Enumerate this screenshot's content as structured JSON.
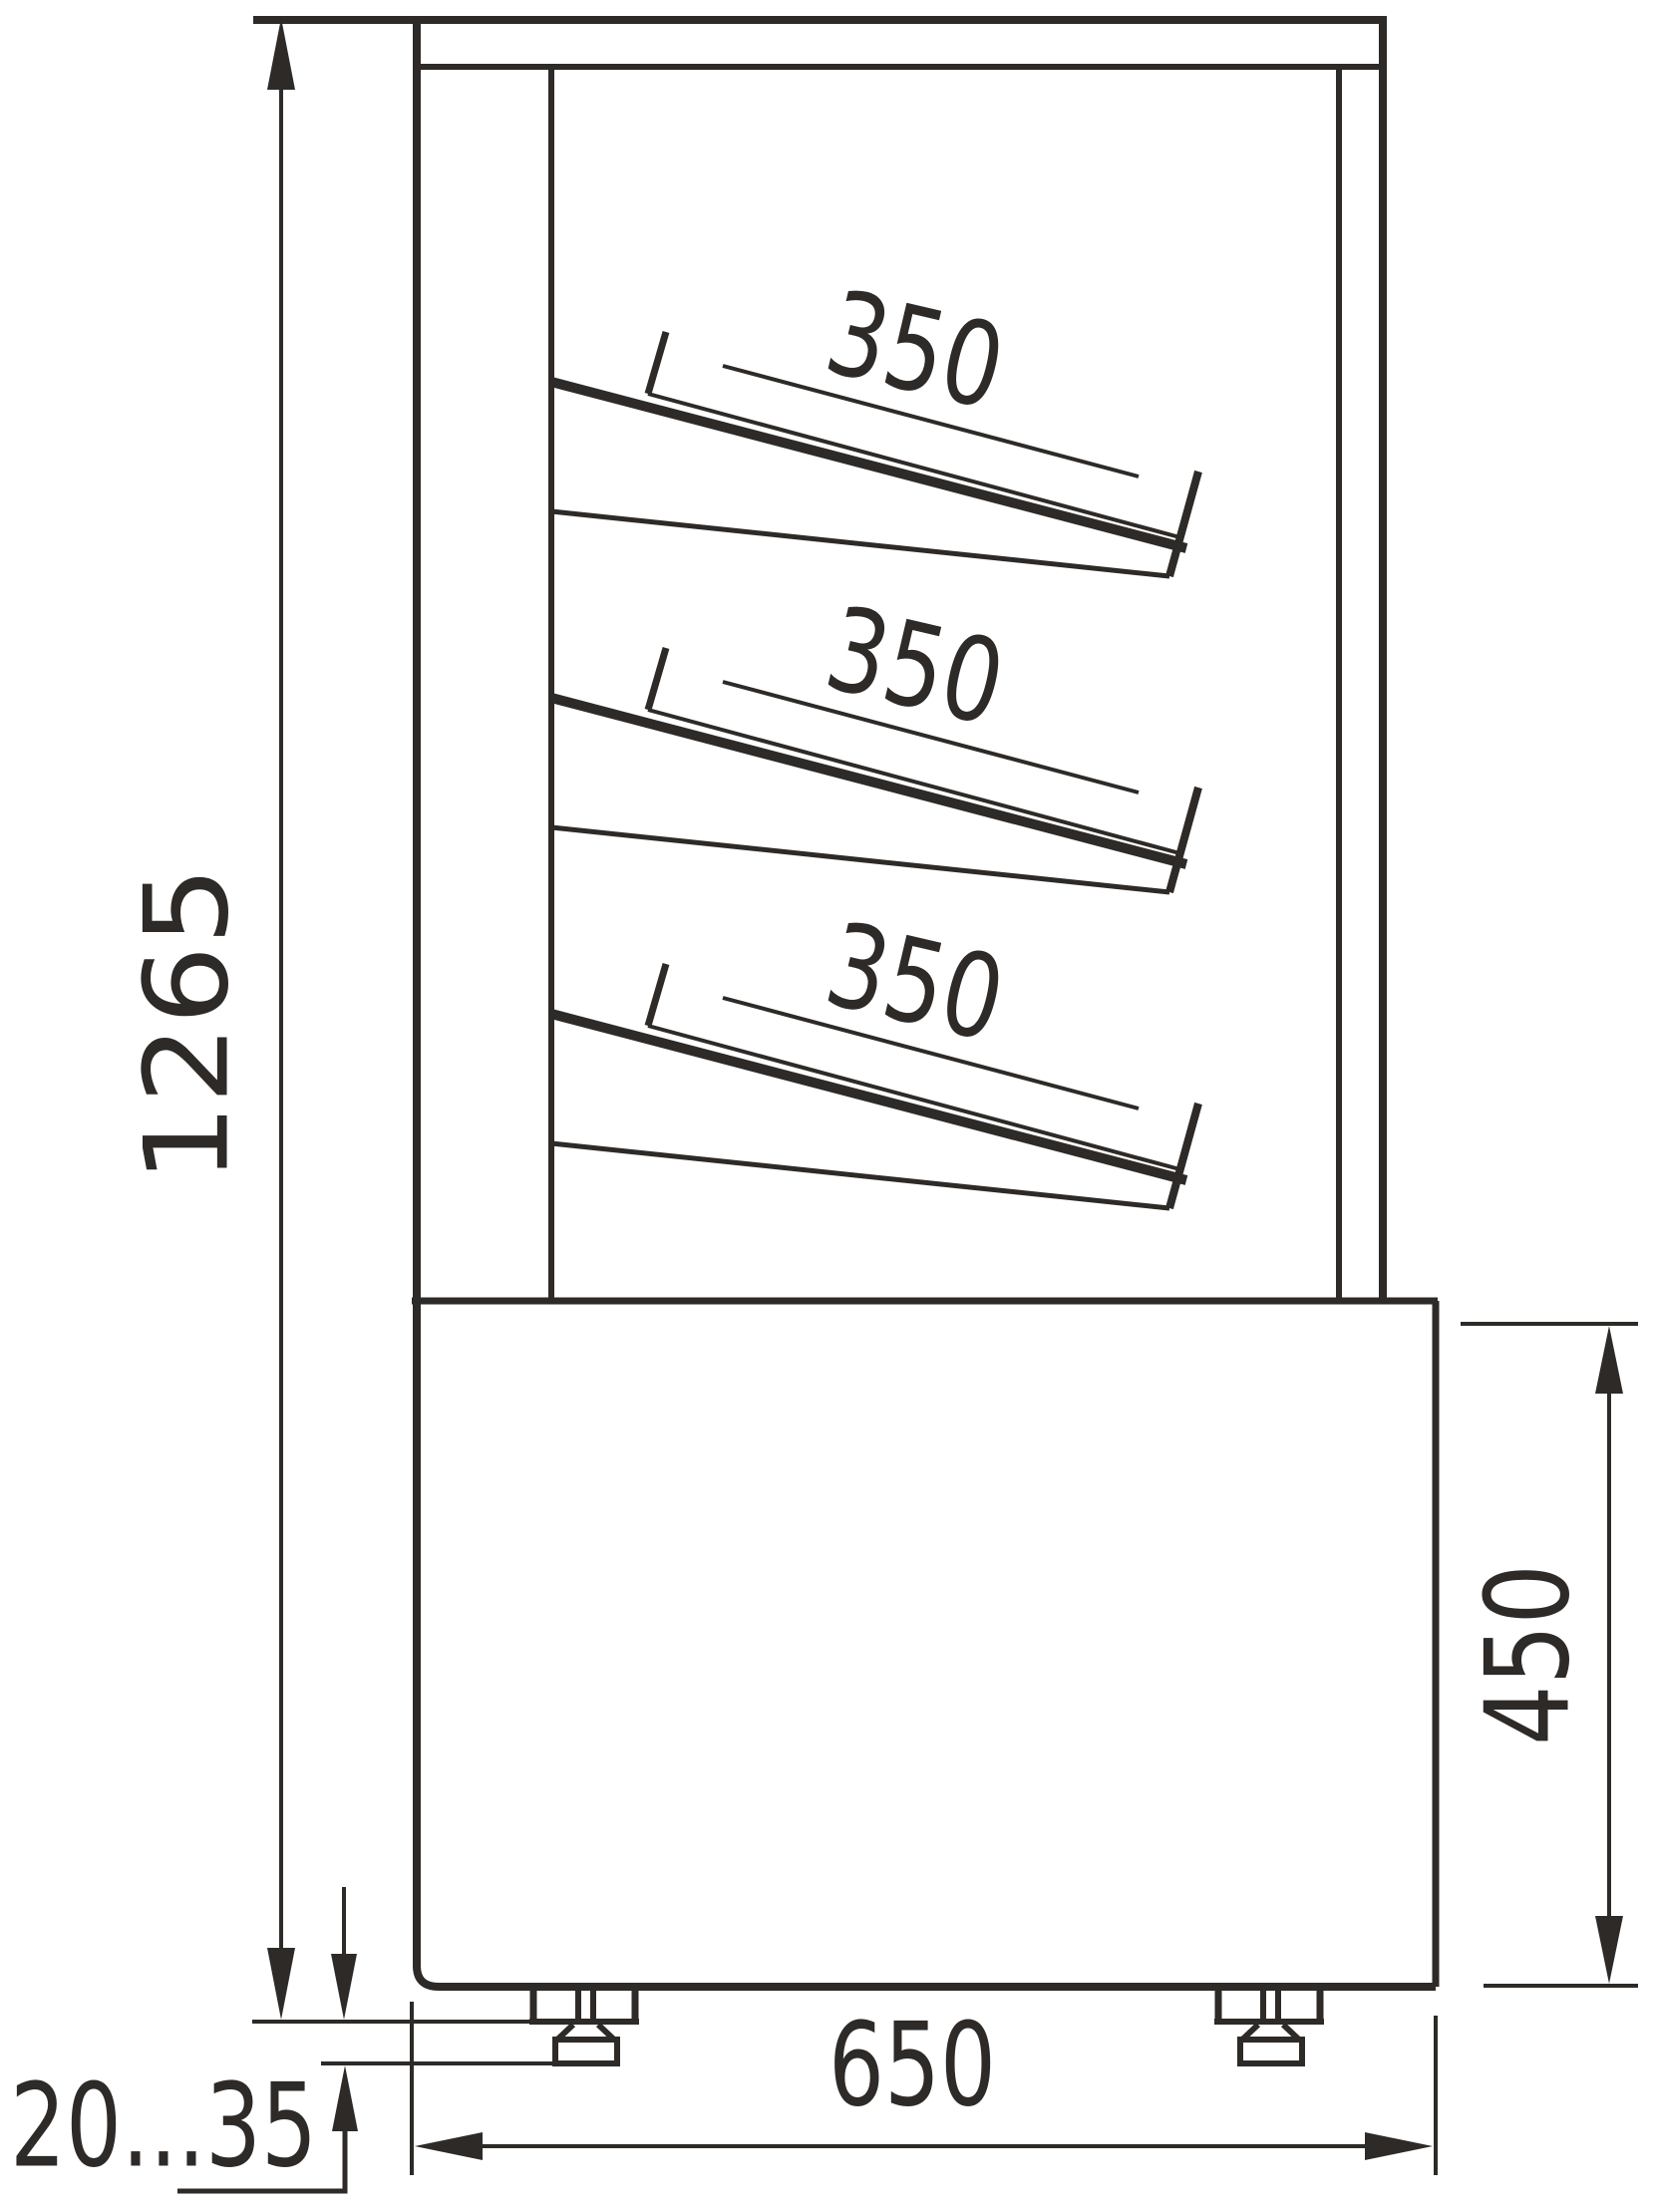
{
  "drawing": {
    "type": "technical-side-view",
    "subject": "display-case-with-three-slanted-shelves-on-base-with-adjustable-feet",
    "units_implied": "mm",
    "line_color": "#2d2a27",
    "background_color": "#ffffff",
    "dims": {
      "overall_height": "1265",
      "base_height": "450",
      "base_depth": "650",
      "foot_adjust_range": "20...35",
      "shelf_labels": [
        "350",
        "350",
        "350"
      ]
    },
    "dimension_list": [
      {
        "name": "overall-height",
        "value": "1265",
        "orientation": "vertical",
        "side": "left"
      },
      {
        "name": "shelf-depth-top",
        "value": "350",
        "orientation": "sloped",
        "side": "inside-top"
      },
      {
        "name": "shelf-depth-middle",
        "value": "350",
        "orientation": "sloped",
        "side": "inside-middle"
      },
      {
        "name": "shelf-depth-bottom",
        "value": "350",
        "orientation": "sloped",
        "side": "inside-bottom"
      },
      {
        "name": "base-height",
        "value": "450",
        "orientation": "vertical",
        "side": "right"
      },
      {
        "name": "base-depth",
        "value": "650",
        "orientation": "horizontal",
        "side": "bottom"
      },
      {
        "name": "foot-adjust-range",
        "value": "20...35",
        "orientation": "vertical",
        "side": "bottom-left"
      }
    ]
  }
}
